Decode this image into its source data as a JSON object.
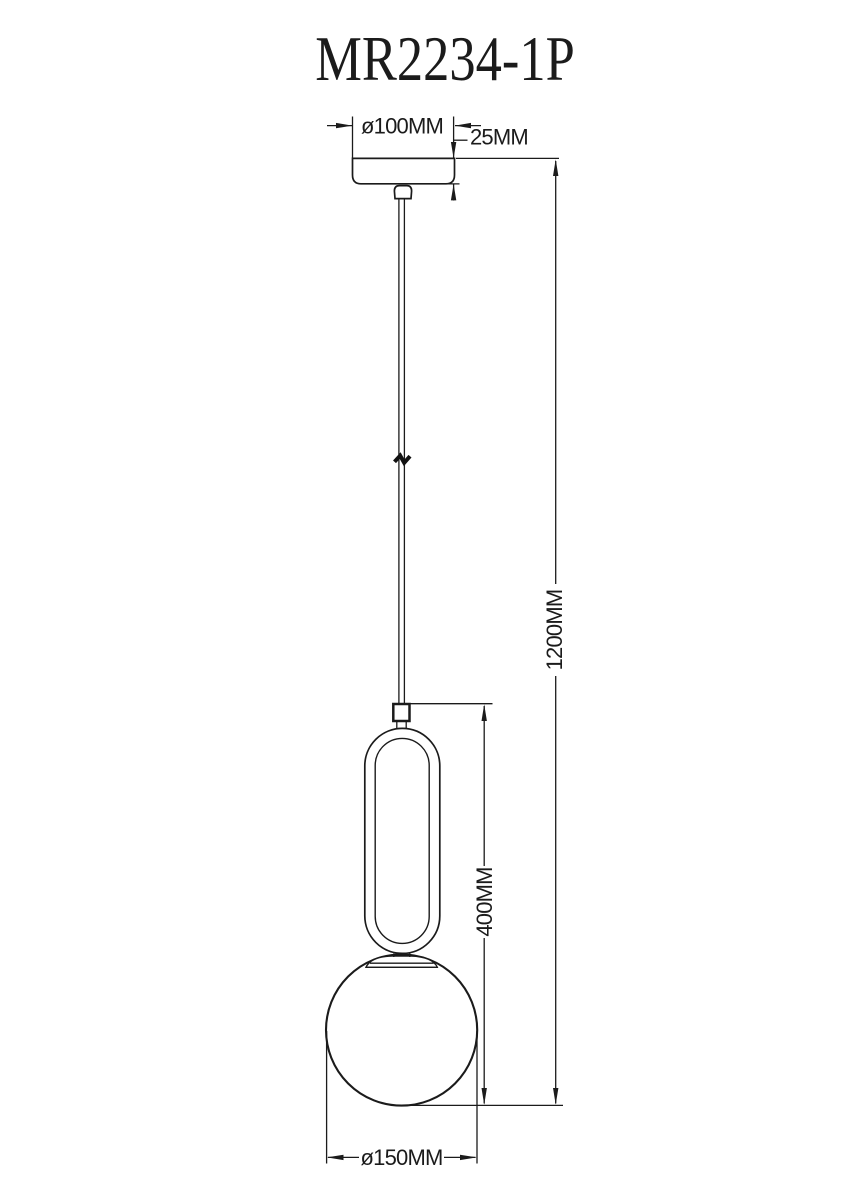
{
  "title": "MR2234-1P",
  "drawing": {
    "dim_canopy_diameter": "ø100MM",
    "dim_canopy_height": "25MM",
    "dim_overall_height": "1200MM",
    "dim_body_height": "400MM",
    "dim_globe_diameter": "ø150MM"
  },
  "colors": {
    "line": "#1b1b1b",
    "background": "#ffffff"
  }
}
